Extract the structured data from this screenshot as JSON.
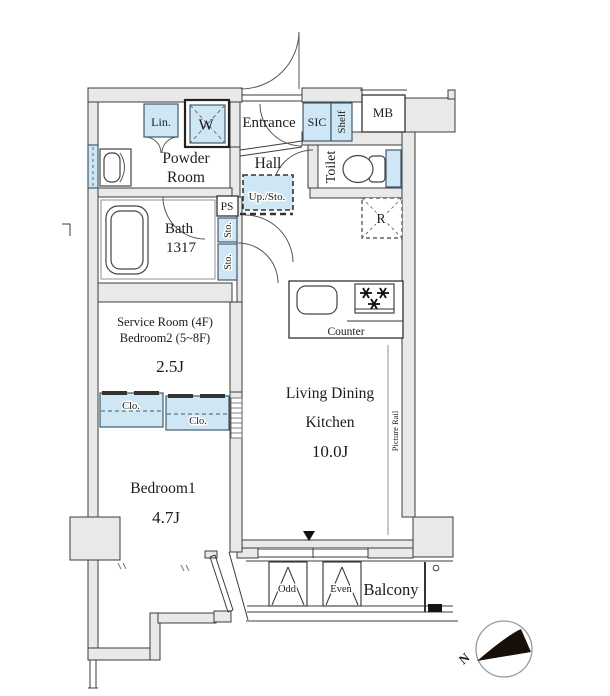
{
  "theme": {
    "accent": "#cfe6f4",
    "wall": "#e9e9e9",
    "line": "#3c3c3c",
    "ink": "#1c1c1c"
  },
  "plan": {
    "upper": {
      "linen": "Lin.",
      "washer": "W",
      "entrance": "Entrance",
      "shoe_closet": "SIC",
      "shelf": "Shelf",
      "meter_box": "MB"
    },
    "rooms": {
      "powder1": "Powder",
      "powder2": "Room",
      "hall": "Hall",
      "toilet": "Toilet",
      "bath": "Bath",
      "bath_size": "1317",
      "service1": "Service Room (4F)",
      "service2": "Bedroom2 (5~8F)",
      "service_area": "2.5J",
      "ldk1": "Living Dining",
      "ldk2": "Kitchen",
      "ldk_area": "10.0J",
      "bedroom1": "Bedroom1",
      "bedroom1_area": "4.7J",
      "balcony": "Balcony"
    },
    "storage": {
      "up_sto": "Up./Sto.",
      "ps": "PS",
      "sto_a": "Sto.",
      "sto_b": "Sto.",
      "clo_a": "Clo.",
      "clo_b": "Clo.",
      "fridge": "R"
    },
    "kitchen": {
      "counter": "Counter"
    },
    "labels": {
      "picture_rail": "Picture Rail",
      "odd": "Odd",
      "even": "Even",
      "north": "N"
    }
  }
}
